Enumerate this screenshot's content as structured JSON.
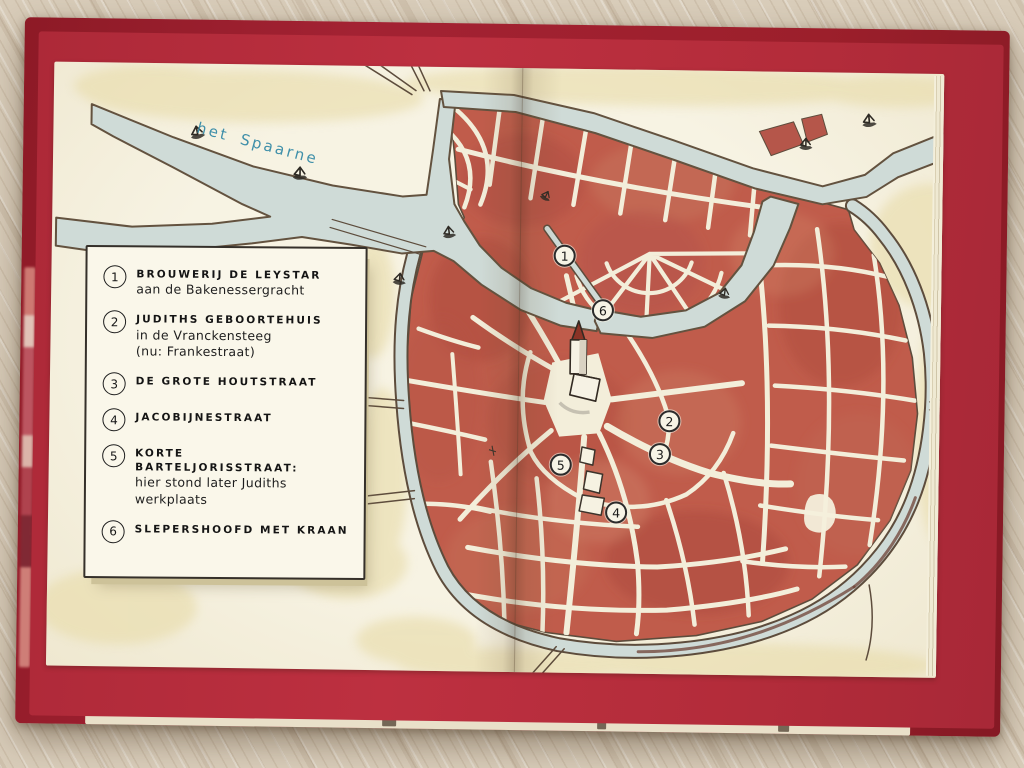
{
  "map": {
    "river_label": "het Spaarne",
    "legend": {
      "items": [
        {
          "number": "1",
          "title": "BROUWERIJ DE LEYSTAR",
          "lines": [
            "aan de Bakenessergracht"
          ]
        },
        {
          "number": "2",
          "title": "JUDITHS GEBOORTEHUIS",
          "lines": [
            "in de Vranckensteeg",
            "(nu: Frankestraat)"
          ]
        },
        {
          "number": "3",
          "title": "DE GROTE HOUTSTRAAT",
          "lines": []
        },
        {
          "number": "4",
          "title": "JACOBIJNESTRAAT",
          "lines": []
        },
        {
          "number": "5",
          "title": "KORTE BARTELJORISSTRAAT:",
          "lines": [
            "hier stond later Judiths",
            "werkplaats"
          ]
        },
        {
          "number": "6",
          "title": "SLEPERSHOOFD MET KRAAN",
          "lines": []
        }
      ]
    },
    "markers": [
      {
        "number": "1",
        "x": 563,
        "y": 255
      },
      {
        "number": "2",
        "x": 670,
        "y": 419
      },
      {
        "number": "3",
        "x": 661,
        "y": 452
      },
      {
        "number": "4",
        "x": 618,
        "y": 511
      },
      {
        "number": "5",
        "x": 562,
        "y": 464
      },
      {
        "number": "6",
        "x": 602,
        "y": 309
      }
    ],
    "boats": [
      {
        "x": 186,
        "y": 134,
        "r": -12,
        "s": 1.2
      },
      {
        "x": 290,
        "y": 172,
        "r": 0,
        "s": 1.2
      },
      {
        "x": 440,
        "y": 230,
        "r": -8,
        "s": 1.1
      },
      {
        "x": 392,
        "y": 276,
        "r": 5,
        "s": 1.1
      },
      {
        "x": 540,
        "y": 190,
        "r": 25,
        "s": 0.9
      },
      {
        "x": 718,
        "y": 286,
        "r": 8,
        "s": 1.0
      },
      {
        "x": 796,
        "y": 136,
        "r": 0,
        "s": 1.1
      },
      {
        "x": 858,
        "y": 112,
        "r": -6,
        "s": 1.2
      }
    ],
    "colors": {
      "cover": "#9c1f2b",
      "endpaper": "#b42c3a",
      "page": "#f4efdc",
      "water": "#cfdbd7",
      "ink": "#5d4c3c",
      "city_red": "#c05c4b",
      "wash_yellow": "#e8dcaa",
      "label_blue": "#3f8fa9"
    }
  }
}
